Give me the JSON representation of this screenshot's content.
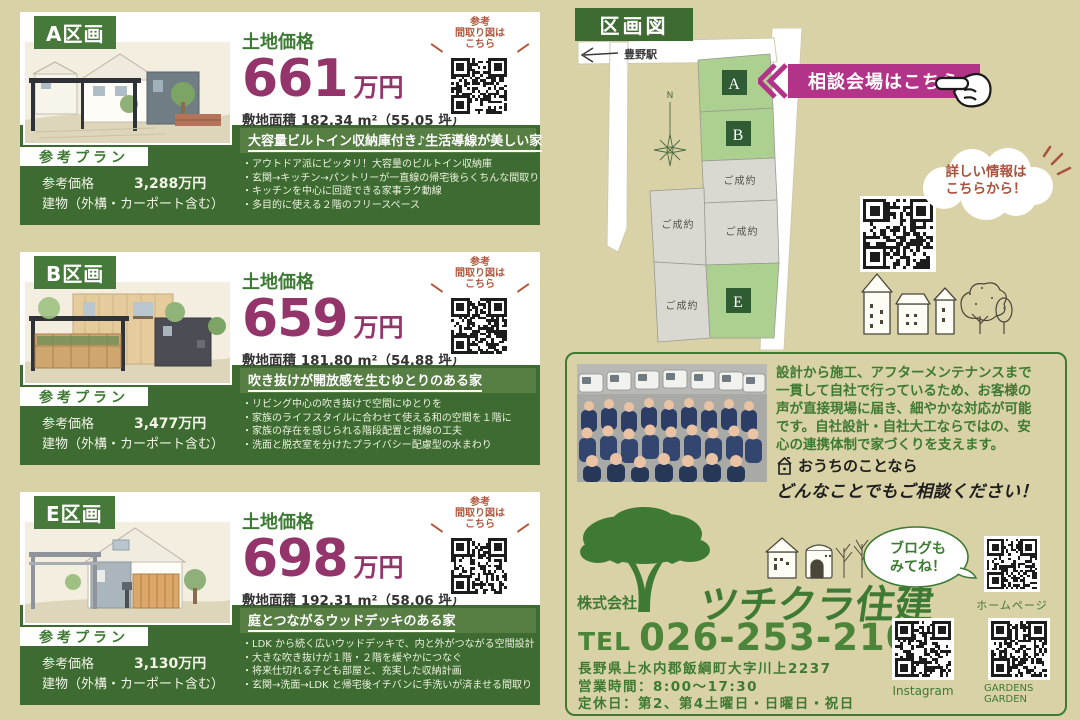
{
  "colors": {
    "page_bg": "#d8d2a6",
    "panel_green": "#3d6b31",
    "badge_green": "#47793a",
    "bar_green": "#577f43",
    "price_magenta": "#93356a",
    "banner_magenta": "#b23388",
    "qr_note_brown": "#b0593f",
    "text_green": "#3f7a33",
    "plot_green": "#abd08f",
    "plot_gray": "#d9d8d1"
  },
  "cards": [
    {
      "badge": "A区画",
      "price_label": "土地価格",
      "price_value": "661",
      "price_unit": "万円",
      "area": "敷地面積 182.34 m²（55.05 坪）",
      "qr_note": "参考\n間取り図は\nこちら",
      "catchphrase": "大容量ビルトイン収納庫付き♪生活導線が美しい家",
      "features": [
        "・アウトドア派にピッタリ！大容量のビルトイン収納庫",
        "・玄関→キッチン→パントリーが一直線の帰宅後らくちんな間取り",
        "・キッチンを中心に回遊できる家事ラク動線",
        "・多目的に使える２階のフリースペース"
      ],
      "plan_label": "参考プラン",
      "ref_price_label": "参考価格",
      "ref_price": "3,288万円",
      "building_note": "建物（外構・カーポート含む）"
    },
    {
      "badge": "B区画",
      "price_label": "土地価格",
      "price_value": "659",
      "price_unit": "万円",
      "area": "敷地面積 181.80 m²（54.88 坪）",
      "qr_note": "参考\n間取り図は\nこちら",
      "catchphrase": "吹き抜けが開放感を生むゆとりのある家",
      "features": [
        "・リビング中心の吹き抜けで空間にゆとりを",
        "・家族のライフスタイルに合わせて使える和の空間を１階に",
        "・家族の存在を感じられる階段配置と視線の工夫",
        "・洗面と脱衣室を分けたプライバシー配慮型の水まわり"
      ],
      "plan_label": "参考プラン",
      "ref_price_label": "参考価格",
      "ref_price": "3,477万円",
      "building_note": "建物（外構・カーポート含む）"
    },
    {
      "badge": "E区画",
      "price_label": "土地価格",
      "price_value": "698",
      "price_unit": "万円",
      "area": "敷地面積 192.31 m²（58.06 坪）",
      "qr_note": "参考\n間取り図は\nこちら",
      "catchphrase": "庭とつながるウッドデッキのある家",
      "features": [
        "・LDK から続く広いウッドデッキで、内と外がつながる空間設計",
        "・大きな吹き抜けが１階・２階を緩やかにつなぐ",
        "・将来仕切れる子ども部屋と、充実した収納計画",
        "・玄関→洗面→LDK と帰宅後イチバンに手洗いが済ませる間取り"
      ],
      "plan_label": "参考プラン",
      "ref_price_label": "参考価格",
      "ref_price": "3,130万円",
      "building_note": "建物（外構・カーポート含む）"
    }
  ],
  "map": {
    "title": "区画図",
    "station": "豊野駅",
    "north": "N",
    "banner": "相談会場はこちら",
    "info_bubble": "詳しい情報は\nこちらから！",
    "plot_a": "A",
    "plot_b": "B",
    "plot_e": "E",
    "sold": "ご成約"
  },
  "company": {
    "description": "設計から施工、アフターメンテナンスまで\n一貫して自社で行っているため、お客様の\n声が直接現場に届き、細やかな対応が可能\nです。自社設計・自社大工ならではの、安\n心の連携体制で家づくりを支えます。",
    "callout1": "おうちのことなら",
    "callout2": "どんなことでもご相談ください！",
    "name_prefix": "株式会社",
    "name": "ツチクラ住建",
    "tel_label": "TEL",
    "tel_number": "026-253-2109",
    "address": "長野県上水内郡飯綱町大字川上2237\n営業時間：8:00〜17:30\n定休日：第2、第4土曜日・日曜日・祝日",
    "blog_bubble": "ブログも\nみてね！",
    "homepage_qr_label": "ホームページ",
    "instagram_qr_label": "Instagram",
    "gardens_qr_label": "GARDENS\nGARDEN"
  }
}
